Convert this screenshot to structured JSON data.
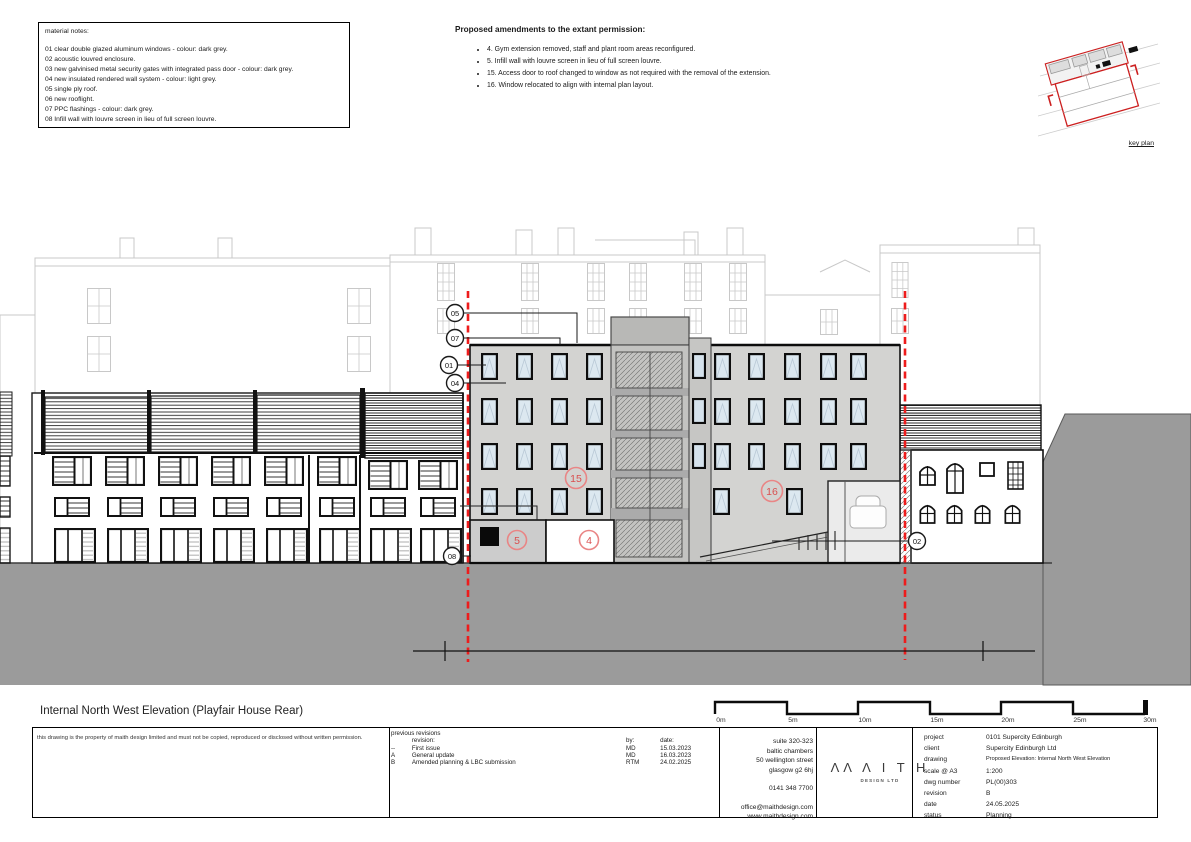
{
  "material_notes": {
    "title": "material notes:",
    "items": [
      "01 clear double glazed aluminum windows - colour: dark grey.",
      "02 acoustic louvred enclosure.",
      "03 new galvinised metal security gates with integrated pass door - colour: dark grey.",
      "04 new insulated rendered wall system - colour: light grey.",
      "05 single ply roof.",
      "06 new rooflight.",
      "07 PPC flashings - colour: dark grey.",
      "08 Infill wall with louvre screen in lieu of full screen louvre."
    ]
  },
  "amendments": {
    "title": "Proposed amendments to the extant permission:",
    "items": [
      "4. Gym extension removed, staff and plant room areas reconfigured.",
      "5. Infill wall with louvre screen in lieu of full screen louvre.",
      "15. Access door to roof changed to window as not required with the removal of the extension.",
      "16. Window relocated to align with internal plan layout."
    ]
  },
  "key_plan": {
    "label": "key plan"
  },
  "drawing": {
    "callouts_black": [
      {
        "label": "05"
      },
      {
        "label": "07"
      },
      {
        "label": "01"
      },
      {
        "label": "04"
      },
      {
        "label": "08"
      },
      {
        "label": "02"
      }
    ],
    "callouts_red": [
      {
        "label": "15"
      },
      {
        "label": "16"
      },
      {
        "label": "5"
      },
      {
        "label": "4"
      }
    ]
  },
  "scale_bar": {
    "labels": [
      "0m",
      "5m",
      "10m",
      "15m",
      "20m",
      "25m",
      "30m"
    ]
  },
  "drawing_title": "Internal North West Elevation (Playfair House Rear)",
  "title_block": {
    "disclaimer": "this drawing is the property of maith design limited and must not be copied, reproduced or disclosed without written permission.",
    "revisions": {
      "header": "previous revisions",
      "col_revision": "revision:",
      "col_by": "by:",
      "col_date": "date:",
      "rows": [
        {
          "rev": "--",
          "desc": "First issue",
          "by": "MD",
          "date": "15.03.2023"
        },
        {
          "rev": "A",
          "desc": "General update",
          "by": "MD",
          "date": "16.03.2023"
        },
        {
          "rev": "B",
          "desc": "Amended planning & LBC submission",
          "by": "RTM",
          "date": "24.02.2025"
        }
      ]
    },
    "address": {
      "lines": [
        "suite 320-323",
        "baltic chambers",
        "50 wellington street",
        "glasgow g2 6hj"
      ],
      "phone": "0141 348 7700",
      "email": "office@maithdesign.com",
      "web": "www.maithdesign.com"
    },
    "logo": {
      "text": "ΛΛ Λ I T H",
      "subtext": "DESIGN LTD"
    },
    "project_info": {
      "rows": [
        {
          "label": "project",
          "value": "0101 Supercity Edinburgh"
        },
        {
          "label": "client",
          "value": "Supercity Edinburgh Ltd"
        },
        {
          "label": "drawing",
          "value": "Proposed Elevation: Internal North West Elevation"
        },
        {
          "label": "scale @ A3",
          "value": "1:200"
        },
        {
          "label": "dwg number",
          "value": "PL(00)303"
        },
        {
          "label": "revision",
          "value": "B"
        },
        {
          "label": "date",
          "value": "24.05.2025"
        },
        {
          "label": "status",
          "value": "Planning"
        }
      ]
    }
  },
  "colors": {
    "red_annotation": "#ee1c1c",
    "red_circle": "#e06060",
    "ground_grey": "#9b9b9b",
    "facade_grey": "#d3d3d1",
    "background_line_grey": "#c8c8c8",
    "glass_blue": "#dce8f0"
  }
}
